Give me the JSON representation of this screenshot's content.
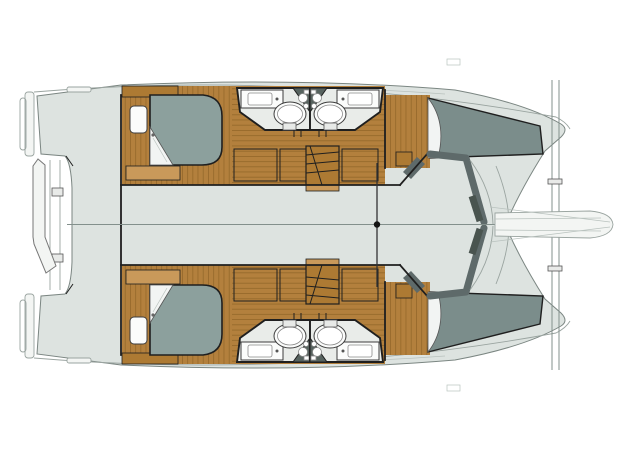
{
  "plan": {
    "title": "Catamaran accommodation deck plan",
    "view": "overhead floor plan, bow pointing right, twin sterns at left",
    "bridgedeck": "open salon deck (unfurnished on this drawing) with centerline and mast bulkhead node",
    "hulls": [
      {
        "side": "upper",
        "rooms": [
          {
            "name": "aft-double-cabin",
            "furniture": [
              "island-double-berth",
              "headboard-cabinet",
              "bedside-unit",
              "foot-locker"
            ]
          },
          {
            "name": "aft-head",
            "furniture": [
              "vanity-sink",
              "round-shower",
              "toilet"
            ]
          },
          {
            "name": "forward-head",
            "furniture": [
              "vanity-sink",
              "round-shower",
              "toilet"
            ]
          },
          {
            "name": "forward-double-cabin",
            "furniture": [
              "double-berth",
              "step-cabinet"
            ]
          }
        ],
        "features": [
          "hanging-wardrobes",
          "companionway-stairs",
          "swim-platform",
          "transom-steps"
        ]
      },
      {
        "side": "lower",
        "rooms": [
          {
            "name": "aft-double-cabin",
            "furniture": [
              "island-double-berth",
              "headboard-cabinet",
              "bedside-unit",
              "foot-locker"
            ]
          },
          {
            "name": "aft-head",
            "furniture": [
              "vanity-sink",
              "round-shower",
              "toilet"
            ]
          },
          {
            "name": "forward-head",
            "furniture": [
              "vanity-sink",
              "round-shower",
              "toilet"
            ]
          },
          {
            "name": "forward-double-cabin",
            "furniture": [
              "double-berth",
              "step-cabinet"
            ]
          }
        ],
        "features": [
          "hanging-wardrobes",
          "companionway-stairs",
          "swim-platform",
          "transom-steps"
        ]
      }
    ],
    "shared_features": [
      "stern-davit-passerelle",
      "forward-crossbeam",
      "bowsprit",
      "trampoline-gap",
      "salon-front-coaming"
    ],
    "counts": {
      "cabins": 4,
      "heads": 4,
      "showers": 4,
      "berths": 4
    }
  },
  "palette": {
    "deck": "#dde3e0",
    "deck-edge": "#7b8682",
    "platform": "#f3f5f3",
    "outline": "#9aa4a0",
    "faint": "#b9c2be",
    "wall": "#1f1f1f",
    "wood": "#b3803d",
    "wood-dark": "#8f6527",
    "wood-cabinet": "#ad7a33",
    "wood-light": "#c9995a",
    "berth-aft": "#8ca09d",
    "berth-fwd": "#7b8d8b",
    "linen": "#f2f4f3",
    "bath-floor": "#e9ece9",
    "fixture": "#fbfcfb",
    "toilet-nook": "#57635f",
    "salon-band": "#5e6a6a",
    "salon-band-dark": "#49544f",
    "beam": "#83908c",
    "beam-marker": "#141414"
  }
}
